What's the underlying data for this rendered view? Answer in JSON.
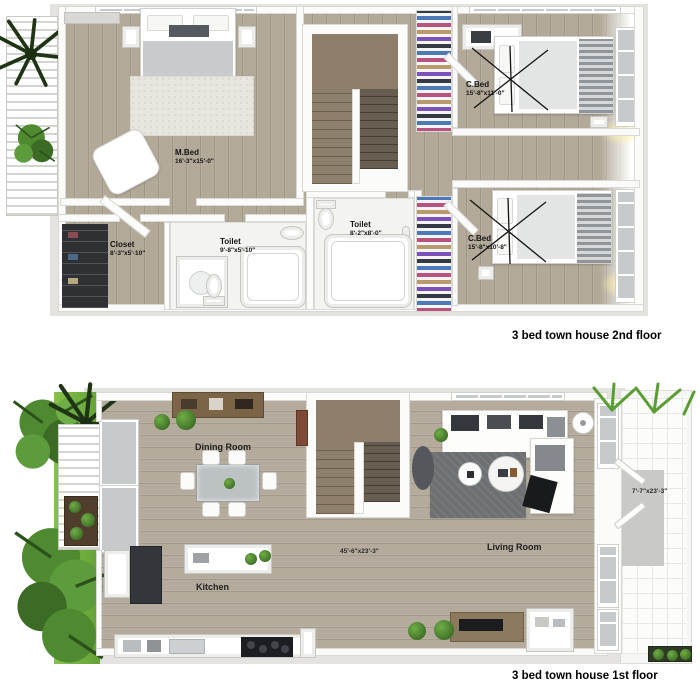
{
  "floor2": {
    "caption": "3 bed town house 2nd floor",
    "mbed_name": "M.Bed",
    "mbed_dims": "16'-3\"x15'-0\"",
    "cbed1_name": "C.Bed",
    "cbed1_dims": "15'-8\"x11'-0\"",
    "cbed2_name": "C.Bed",
    "cbed2_dims": "15'-8\"x10'-8\"",
    "closet_name": "Closet",
    "closet_dims": "8'-3\"x5'-10\"",
    "toilet1_name": "Toilet",
    "toilet1_dims": "9'-8\"x5'-10\"",
    "toilet2_name": "Toilet",
    "toilet2_dims": "8'-2\"x8'-0\""
  },
  "floor1": {
    "caption": "3 bed town house 1st floor",
    "dining_label": "Dining Room",
    "kitchen_label": "Kitchen",
    "living_label": "Living Room",
    "main_dims": "45'-6\"x23'-3\"",
    "patio_dims": "7'-7\"x23'-3\""
  },
  "colors": {
    "wood_floor": "#b3aa9b",
    "wall_white": "#fbfbfa",
    "outer_wall": "#e4e3e0",
    "grass": "#74b342",
    "stair_carpet": "#8e7e6c",
    "dark_rug": "#6d7072",
    "caption_text": "#000000"
  }
}
